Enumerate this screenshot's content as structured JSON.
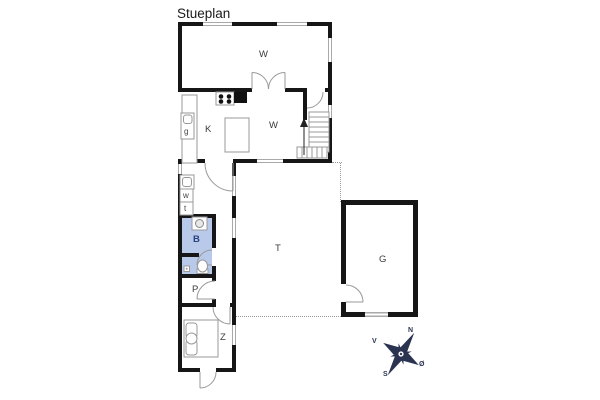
{
  "title": "Stueplan",
  "rooms": {
    "living": {
      "label": "W"
    },
    "kitchen": {
      "label": "K"
    },
    "family": {
      "label": "W"
    },
    "bathroom": {
      "label": "B"
    },
    "hall": {
      "label": "P"
    },
    "bedroom": {
      "label": "Z"
    },
    "terrace": {
      "label": "T"
    },
    "garage": {
      "label": "G"
    }
  },
  "fixtures": {
    "appliance": {
      "label": "g"
    },
    "washing_machine": {
      "label": "w"
    },
    "dryer": {
      "label": "t"
    }
  },
  "compass": {
    "north": "N",
    "east": "Ø",
    "south": "S",
    "west": "V"
  },
  "colors": {
    "wall": "#161616",
    "window": "#a9a9a9",
    "bathroom-fill": "#b9c9ea",
    "bathroom-label": "#27407e",
    "outline": "#999999",
    "compass": "#2a3450"
  }
}
